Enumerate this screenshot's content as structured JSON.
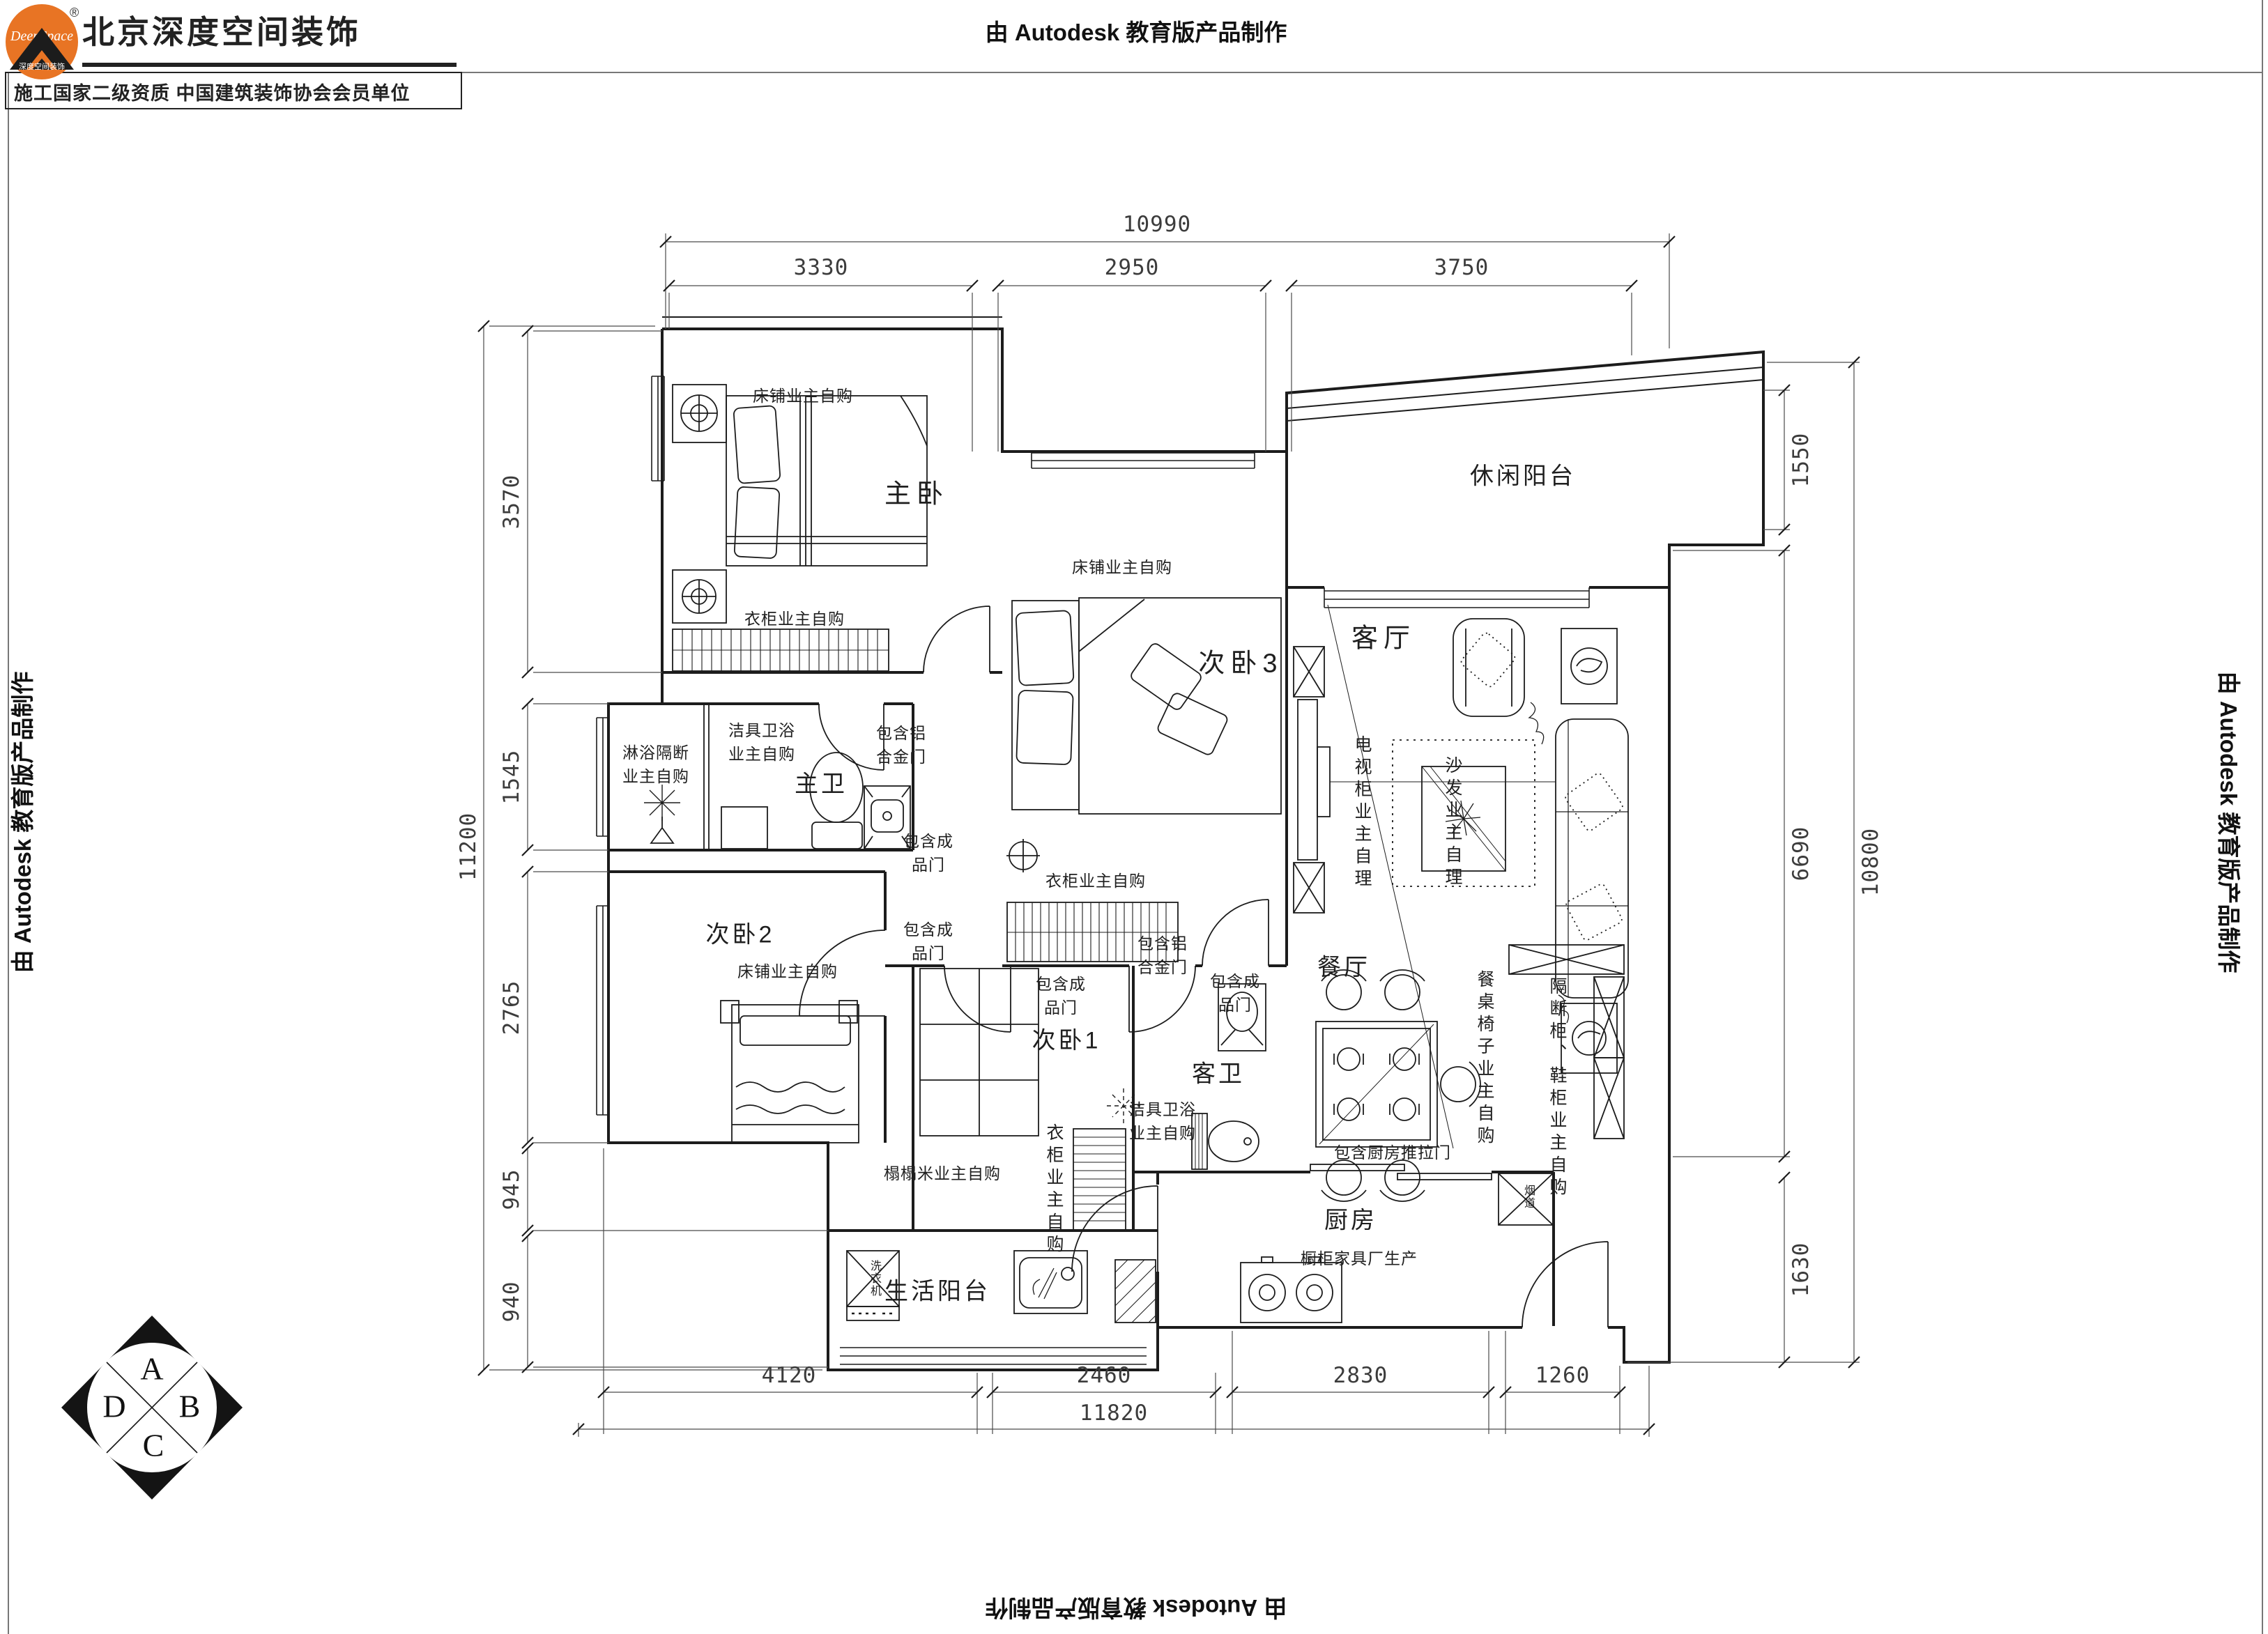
{
  "watermark": {
    "top": "由 Autodesk 教育版产品制作",
    "left": "由 Autodesk 教育版产品制作",
    "right": "由 Autodesk 教育版产品制作",
    "bottom": "由 Autodesk 教育版产品制作"
  },
  "header": {
    "brand": "北京深度空间装饰",
    "subtitle": "施工国家二级资质 中国建筑装饰协会会员单位",
    "logo_script": "DeepSpace",
    "logo_caption": "深度空间装饰",
    "registered_mark": "®"
  },
  "rooms": {
    "master_bedroom": "主卧",
    "bedroom3": "次卧3",
    "bedroom2": "次卧2",
    "bedroom1": "次卧1",
    "master_bath": "主卫",
    "guest_bath": "客卫",
    "living_room": "客厅",
    "dining_room": "餐厅",
    "kitchen": "厨房",
    "leisure_balcony": "休闲阳台",
    "utility_balcony": "生活阳台"
  },
  "notes": {
    "bed_owner_master": "床铺业主自购",
    "bed_owner_bed3": "床铺业主自购",
    "bed_owner_bed2": "床铺业主自购",
    "wardrobe_owner_master": "衣柜业主自购",
    "wardrobe_owner_bed3": "衣柜业主自购",
    "wardrobe_owner_bed1": "衣柜业主自购",
    "tatami": "榻榻米业主自购",
    "shower_partition": [
      "淋浴隔断",
      "业主自购"
    ],
    "sanitary_master": [
      "洁具卫浴",
      "业主自购"
    ],
    "sanitary_guest": [
      "洁具卫浴",
      "业主自购"
    ],
    "alu_door_master_bath": [
      "包含铝",
      "合金门"
    ],
    "alu_door_guest_bath": [
      "包含铝",
      "合金门"
    ],
    "finished_door_hall": [
      "包含成",
      "品门"
    ],
    "finished_door_bed2": [
      "包含成",
      "品门"
    ],
    "finished_door_bed1": [
      "包含成",
      "品门"
    ],
    "finished_door_bed3": [
      "包含成",
      "品门"
    ],
    "tv_cabinet": "电视柜业主自理",
    "sofa": "沙发业主自理",
    "dining_set": "餐桌椅子业主自购",
    "partition_shoe_cabinet": "隔断柜、鞋柜业主自购",
    "kitchen_sliding_door": "包含厨房推拉门",
    "cabinet_factory": "橱柜家具厂生产",
    "washer": "洗衣机",
    "flue": "烟道"
  },
  "dimensions": {
    "top_total": "10990",
    "top": [
      "3330",
      "2950",
      "3750"
    ],
    "left_total": "11200",
    "left": [
      "3570",
      "1545",
      "2765",
      "945",
      "940"
    ],
    "right": [
      "1550",
      "6690",
      "1630"
    ],
    "right_total": "10800",
    "bottom": [
      "4120",
      "2460",
      "2830",
      "1260"
    ],
    "bottom_total": "11820"
  },
  "compass": {
    "top": "A",
    "right": "B",
    "bottom": "C",
    "left": "D"
  }
}
